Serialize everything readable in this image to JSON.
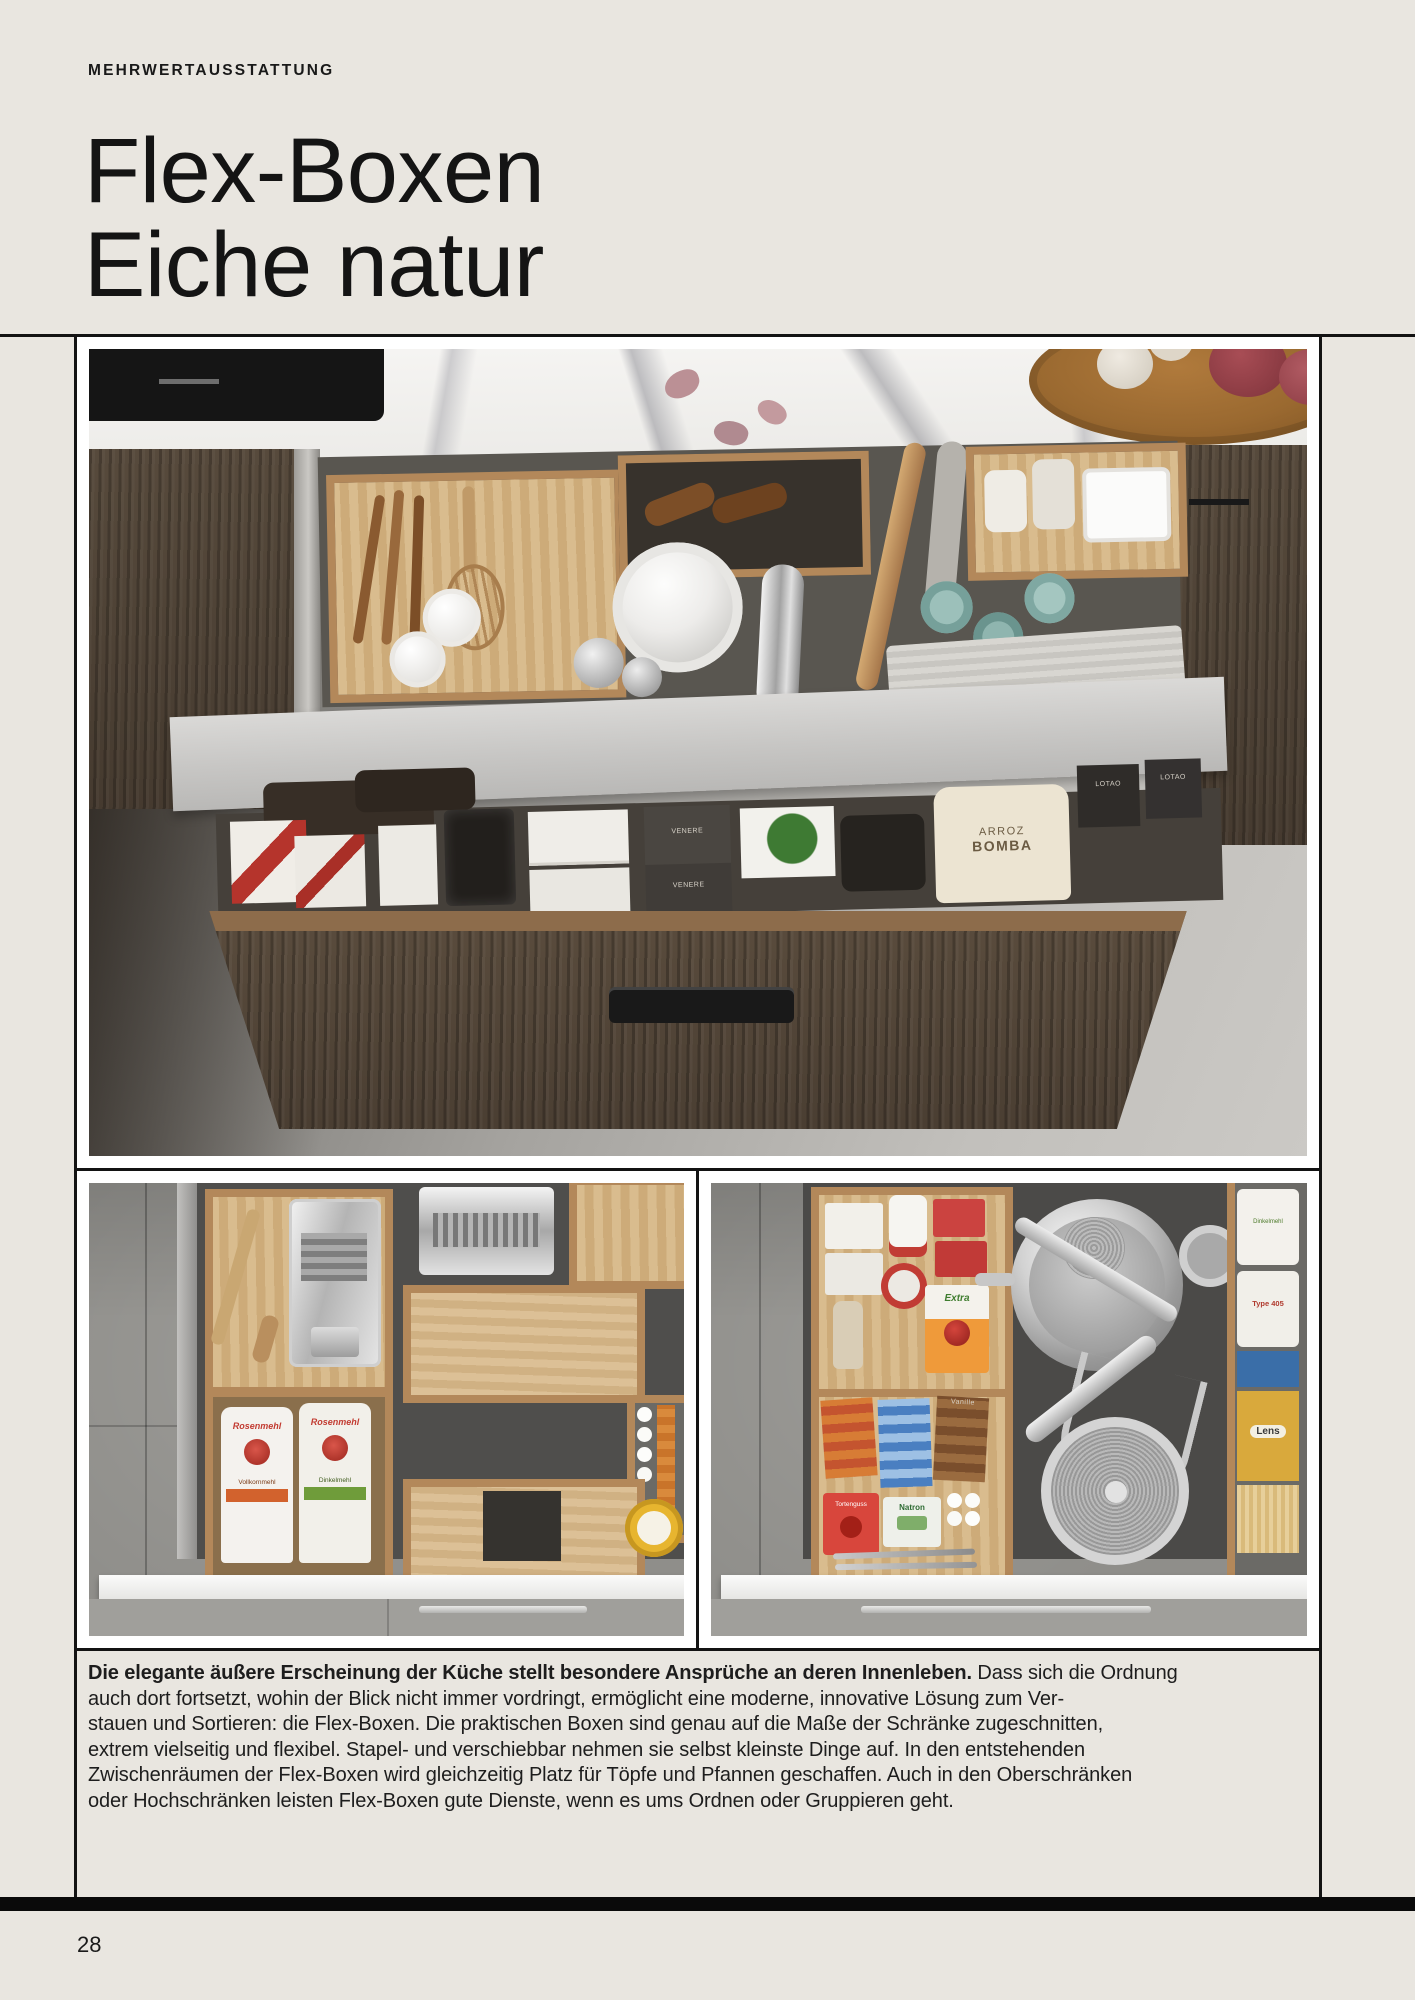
{
  "page": {
    "kicker": "MEHRWERTAUSSTATTUNG",
    "title_line1": "Flex-Boxen",
    "title_line2": "Eiche natur",
    "page_number": "28"
  },
  "body": {
    "l1_bold": "Die elegante äußere Erscheinung der Küche stellt besondere Ansprüche an deren Innenleben.",
    "l1_rest": " Dass sich die Ordnung",
    "l2": "auch dort fortsetzt, wohin der Blick nicht immer vordringt, ermöglicht eine moderne, innovative Lösung zum Ver-",
    "l3": "stauen und Sortieren: die Flex-Boxen. Die praktischen Boxen sind genau auf die Maße der Schränke zugeschnitten,",
    "l4": "extrem vielseitig und flexibel. Stapel- und verschiebbar nehmen sie selbst kleinste Dinge auf. In den entstehenden",
    "l5": "Zwischenräumen der Flex-Boxen wird gleichzeitig Platz für Töpfe und Pfannen geschaffen. Auch in den Oberschränken",
    "l6": "oder Hochschränken leisten Flex-Boxen gute Dienste, wenn es ums Ordnen oder Gruppieren geht."
  },
  "photo_labels": {
    "flour_brand": "Rosenmehl",
    "flour_left_variant": "Vollkornmehl",
    "flour_right_variant": "Dinkelmehl",
    "rice_line1": "ARROZ",
    "rice_line2": "BOMBA",
    "lotao": "LOTAO",
    "venere": "VENERE",
    "gelierzucker": "Extra",
    "natron": "Natron",
    "vanille": "Vanille",
    "tortenguss": "Tortenguss",
    "type405": "Type 405",
    "lentils": "Lens"
  },
  "colors": {
    "page_bg": "#e9e6e0",
    "ink": "#141414",
    "rule": "#131313",
    "photo_mat": "#ffffff",
    "bottom_band": "#0a0a0a",
    "oak_light": "#cdab79",
    "oak_dark": "#4f4236",
    "drawer_gray": "#595650",
    "marble_white": "#f3f2f0",
    "floor_gray": "#b4b2ae",
    "accent_red": "#c03a2e",
    "accent_green": "#6f9c3a",
    "accent_orange": "#d2622d",
    "accent_yellow": "#e7b52f",
    "accent_teal": "#9cc0ba"
  }
}
